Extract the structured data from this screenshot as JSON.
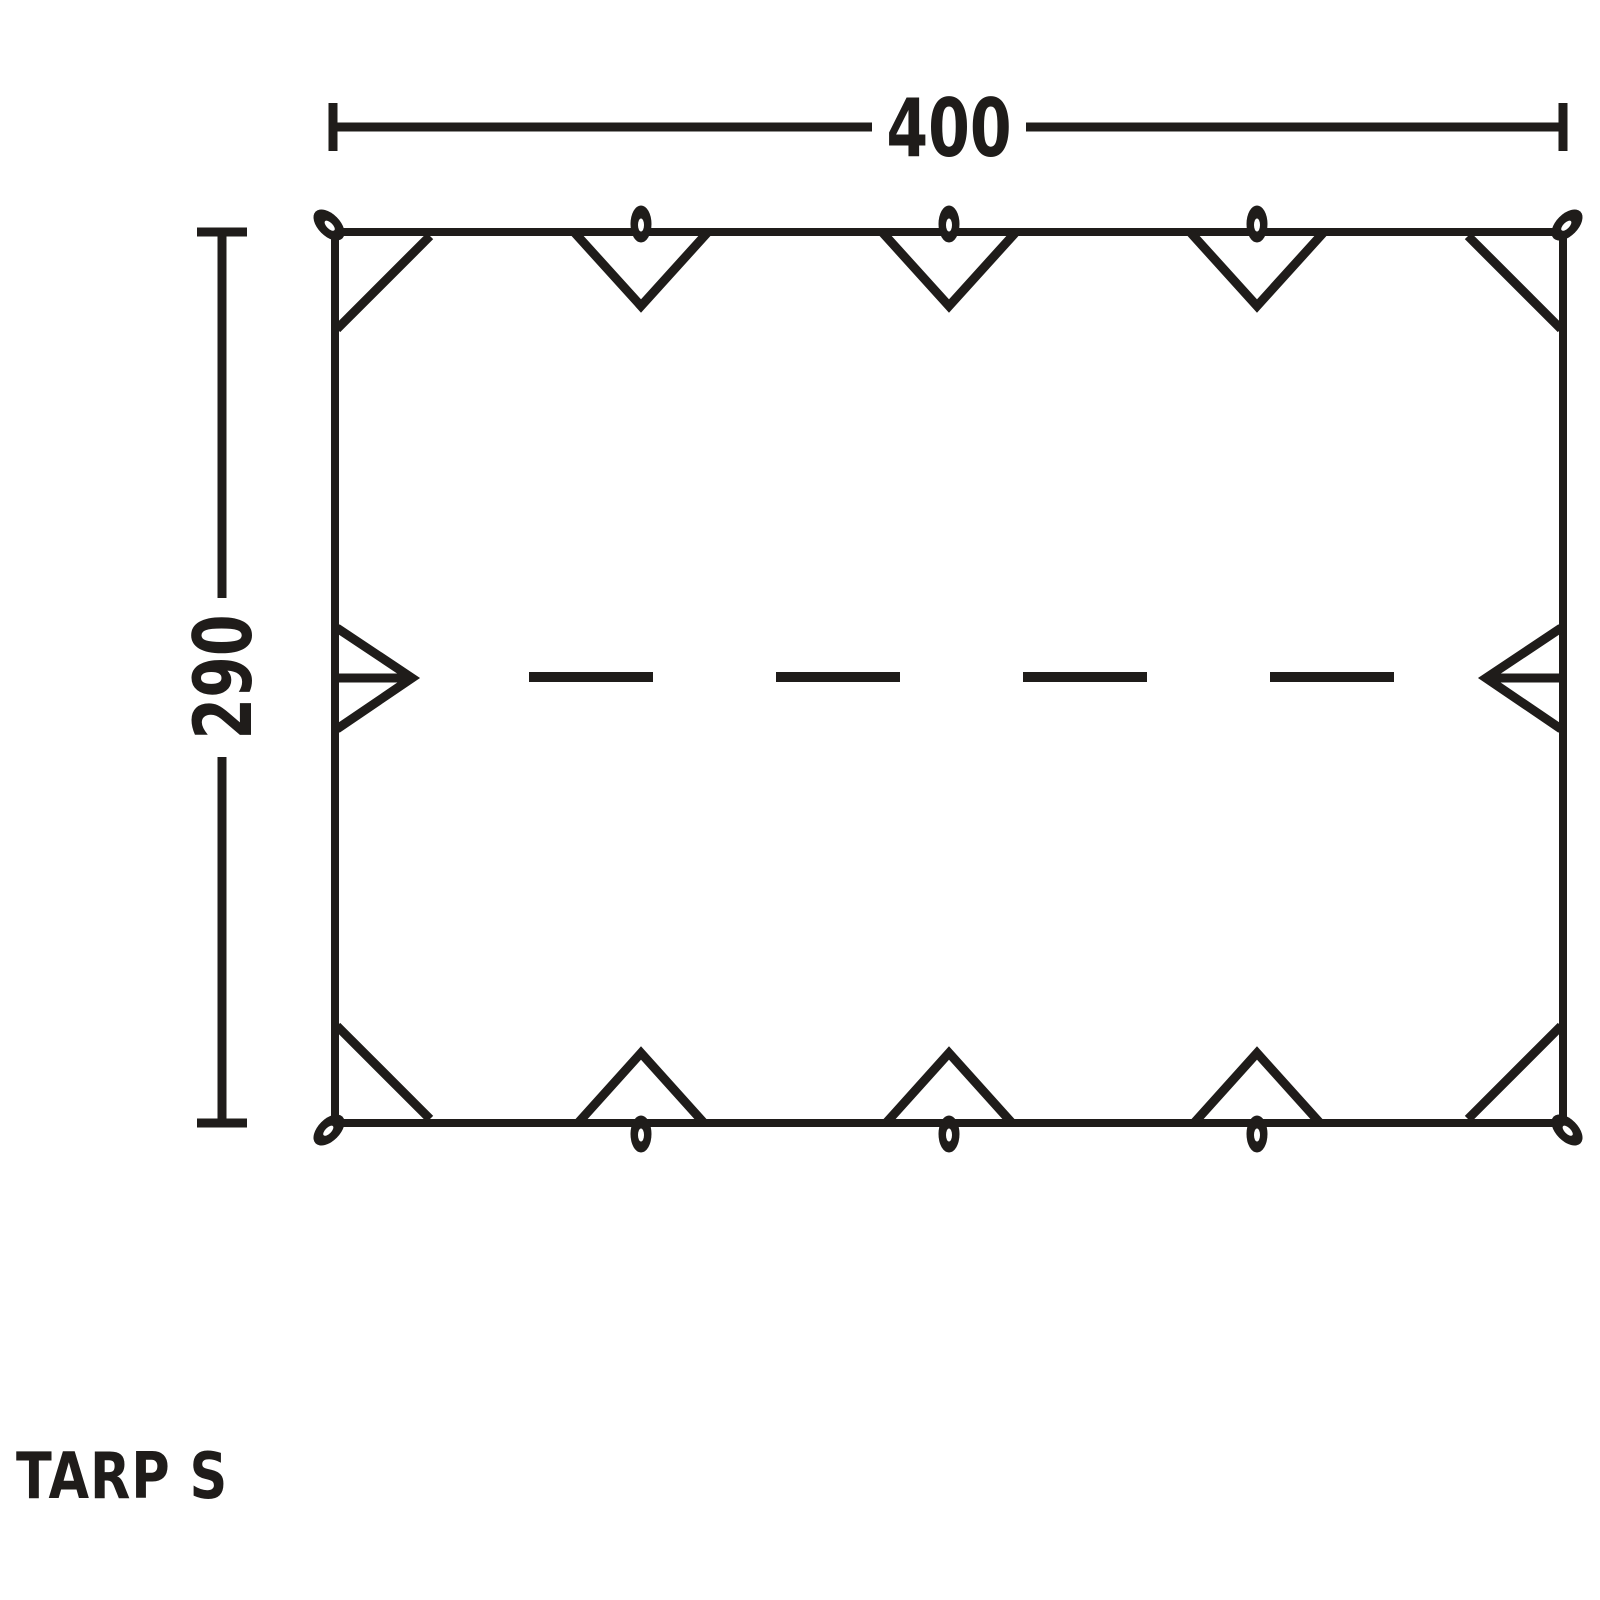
{
  "diagram": {
    "product_name": "TARP S",
    "dimensions": {
      "width": "400",
      "height": "290"
    },
    "colors": {
      "ink": "#1f1c1a",
      "background": "#ffffff"
    },
    "icons": {
      "guy_loop": "small filled oval loop with white slit",
      "tieout_triangle": "open triangle notch pointing into tarp",
      "side_tieout_arrow": "triangle with center line pointing into tarp",
      "corner_reinforcement": "diagonal seam line across corner"
    }
  }
}
